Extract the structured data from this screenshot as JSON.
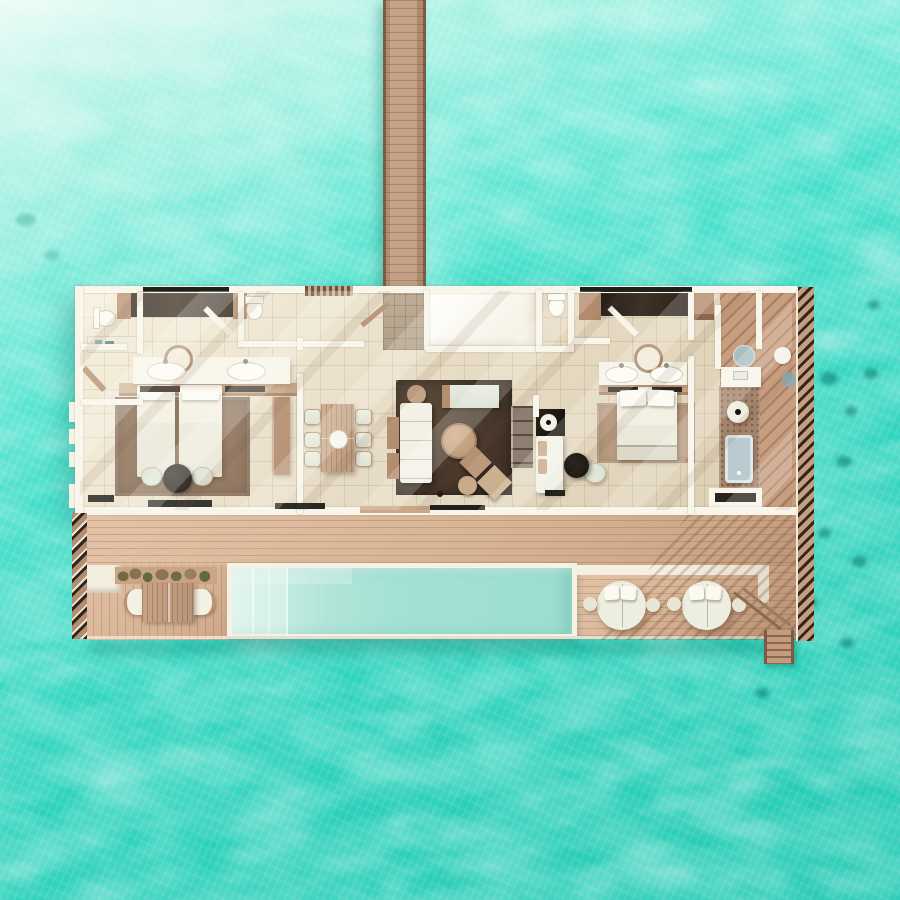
{
  "scene": {
    "description": "Top-down 3D architectural render of a two-bedroom overwater pool villa connected to a wooden jetty, surrounded by turquoise lagoon water with a pale sandbank at the top and seagrass patches to the right",
    "view": "top-down orthographic floor plan",
    "lighting": "daylight, sun casting diagonal streaks from upper-left"
  },
  "colors": {
    "water_top": "#c9f6ec",
    "water_upper": "#9ff0e1",
    "water_mid": "#4ae2cd",
    "water_deep": "#30d9c2",
    "water_streak": "#e8fcf5",
    "seagrass": "#0c8a7a",
    "pier_wood": "#c5a186",
    "pier_edge": "#7e5d48",
    "deck_wood": "#d8b496",
    "wall": "#f8f5ea",
    "floor_a": "#f2ead6",
    "floor_b": "#dccfb5",
    "rug_guest": "#8a6c54",
    "rug_living": "#46362a",
    "rug_master": "#b89c82",
    "sage": "#dfe5d8",
    "wood_trim": "#b28b6c",
    "wood_light": "#c9a788",
    "wardrobe": "#292119",
    "black_accent": "#15120e",
    "pool_light": "#d5f0e9",
    "pool_main": "#9cdecf",
    "tub": "#b9cbd1",
    "stone": "#a5846c",
    "stripe_light": "#c89e80",
    "stripe_dark": "#a87f63",
    "louver": "#33281f",
    "metal": "#9fb3b8",
    "plant": "#6e6b45"
  },
  "villa": {
    "rooms": [
      {
        "name": "guest-bathroom",
        "fixtures": [
          "toilet",
          "shelf",
          "bench"
        ]
      },
      {
        "name": "guest-bedroom",
        "fixtures": [
          "wardrobe",
          "twin-beds",
          "double-sink-vanity",
          "round-mirror",
          "rug",
          "black-ottoman",
          "two-chairs"
        ]
      },
      {
        "name": "powder-room-left",
        "fixtures": [
          "toilet"
        ]
      },
      {
        "name": "entry-vestibule",
        "fixtures": [
          "tiled-floor",
          "door"
        ]
      },
      {
        "name": "foyer",
        "fixtures": []
      },
      {
        "name": "powder-room-right",
        "fixtures": [
          "toilet"
        ]
      },
      {
        "name": "dining-area",
        "fixtures": [
          "table-for-six",
          "sideboard",
          "centerpiece-bowl"
        ]
      },
      {
        "name": "living-room",
        "fixtures": [
          "sofa",
          "chaise",
          "round-ottoman",
          "two-poufs",
          "stools",
          "tv-console",
          "dark-rug"
        ]
      },
      {
        "name": "minibar-nook",
        "fixtures": [
          "black-counter",
          "lounge-chair",
          "round-black-table",
          "chair"
        ]
      },
      {
        "name": "master-bedroom",
        "fixtures": [
          "wardrobe",
          "king-bed",
          "foot-bench",
          "double-sink-vanity",
          "round-mirror",
          "rug"
        ]
      },
      {
        "name": "master-bathroom",
        "fixtures": [
          "bathtub",
          "sink-counter",
          "stone-platform",
          "stool",
          "bench"
        ]
      },
      {
        "name": "outdoor-shower-deck",
        "fixtures": [
          "shower-trays",
          "diagonal-planks",
          "louver-screen"
        ]
      }
    ],
    "counts": {
      "bedrooms": 2,
      "beds": 3,
      "dining_chairs": 6,
      "toilets": 3,
      "sinks": 5,
      "bathtubs": 1
    }
  },
  "exterior": {
    "jetty": "wooden walkway entering from top edge",
    "sun_deck": "full-width lower deck",
    "pool": "rectangular plunge pool with entry steps at left",
    "outdoor_dining": {
      "table": 1,
      "bench_seats": 2,
      "planter": 1
    },
    "daybeds": 2,
    "daybed_side_tables": 4,
    "sea_ladder": 1,
    "louver_screens": 2
  }
}
